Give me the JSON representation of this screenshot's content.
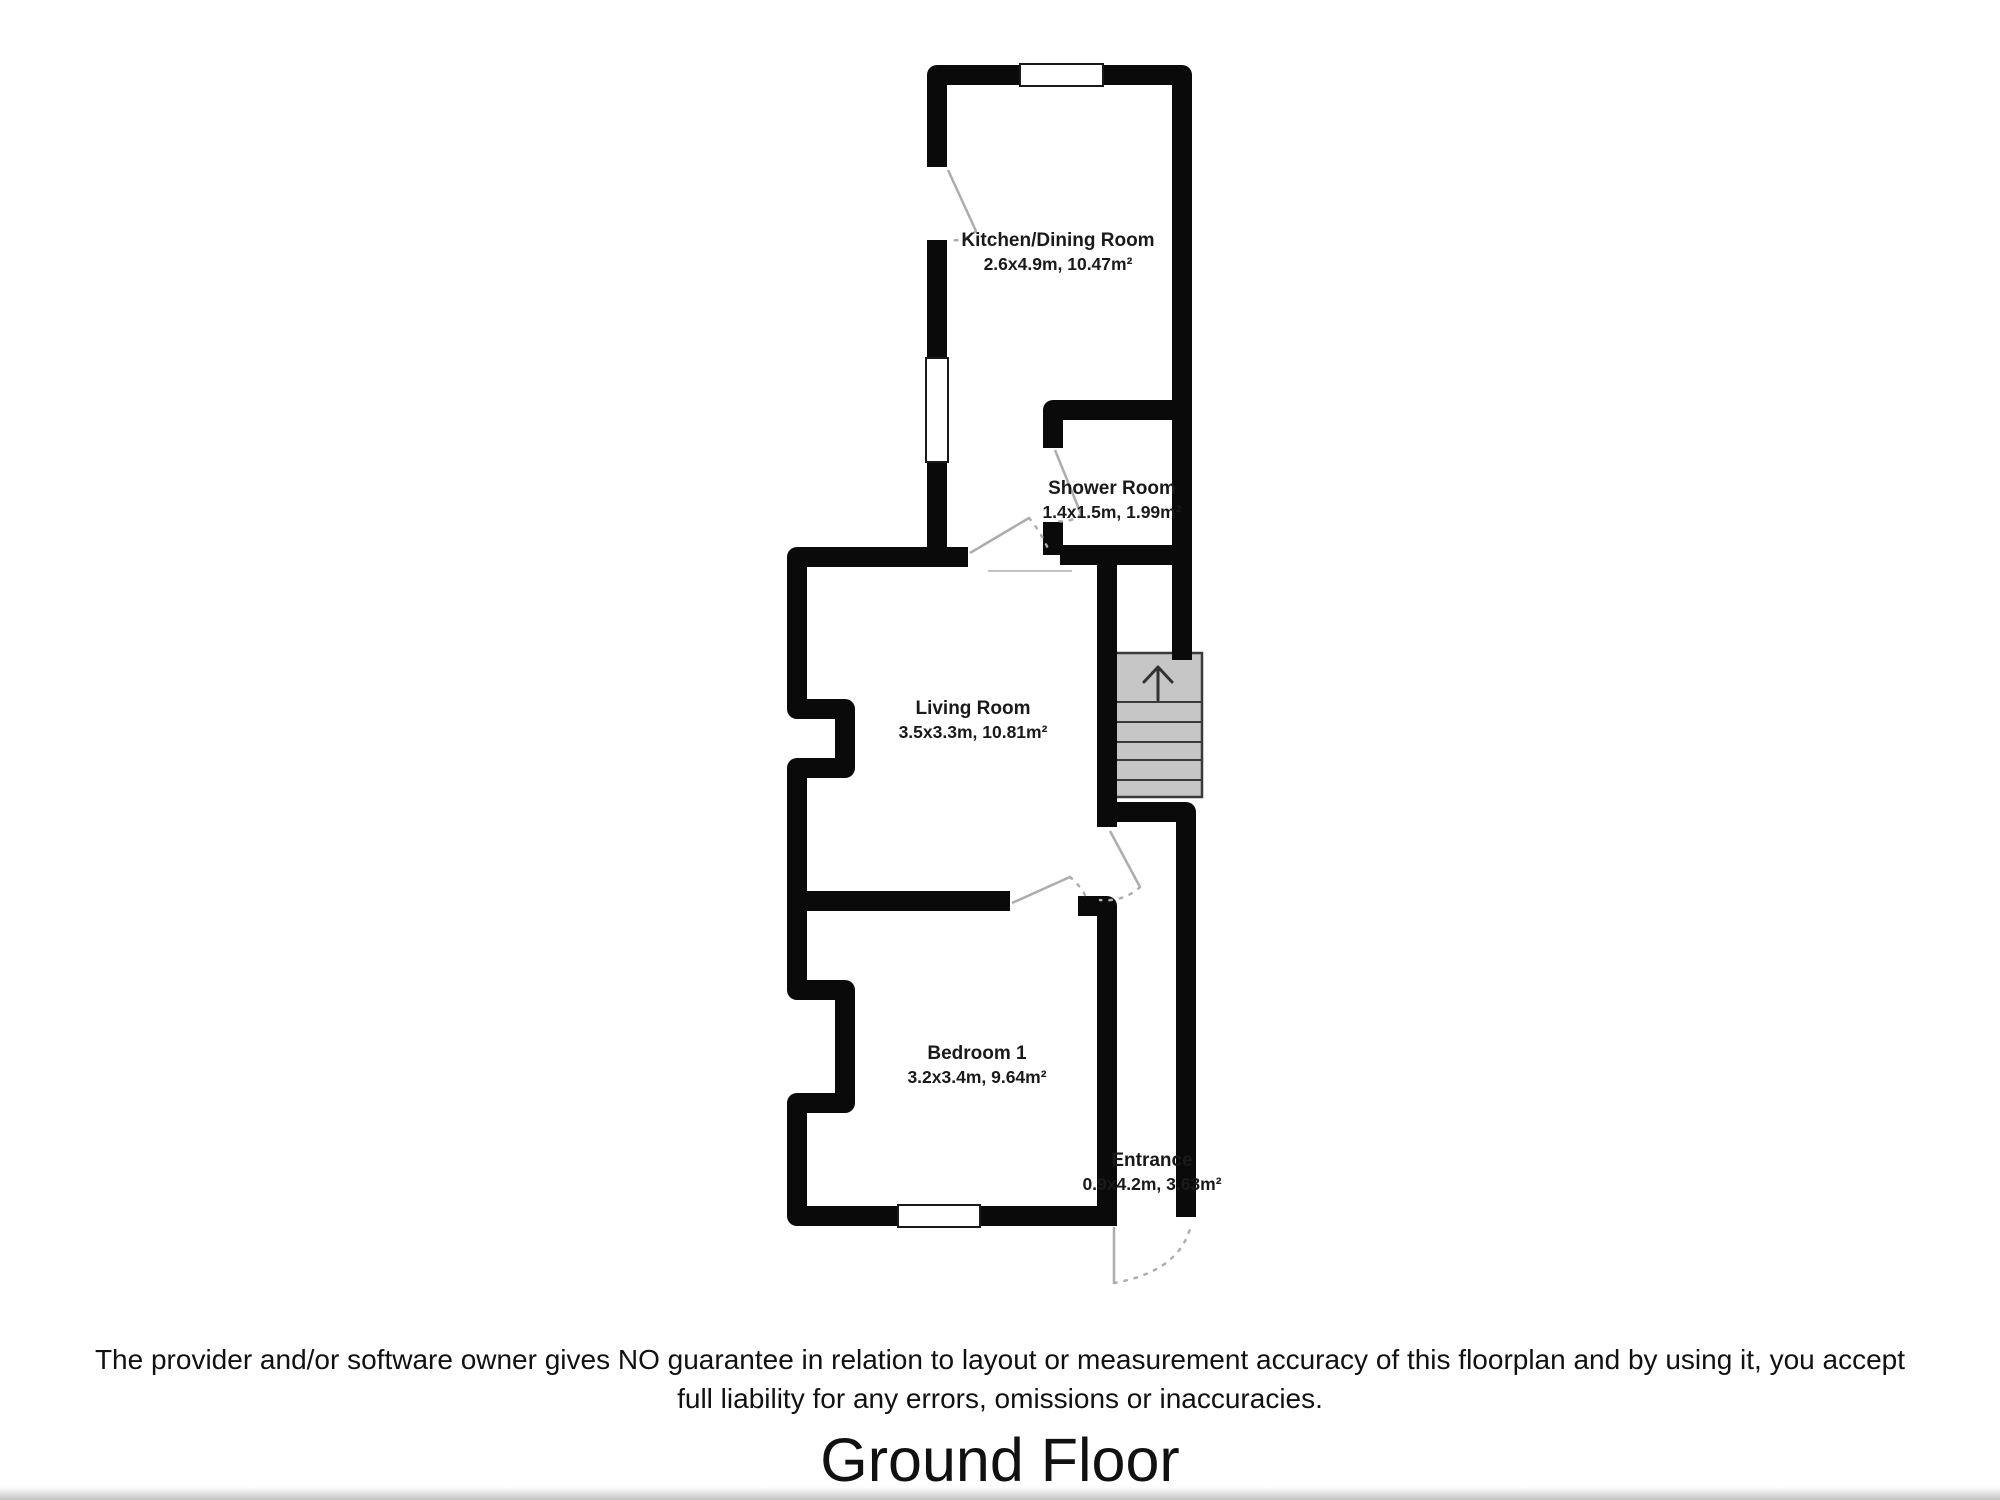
{
  "floorplan": {
    "rooms": [
      {
        "id": "kitchen-dining",
        "name": "Kitchen/Dining Room",
        "dims": "2.6x4.9m, 10.47m²"
      },
      {
        "id": "shower-room",
        "name": "Shower Room",
        "dims": "1.4x1.5m, 1.99m²"
      },
      {
        "id": "living-room",
        "name": "Living Room",
        "dims": "3.5x3.3m, 10.81m²"
      },
      {
        "id": "bedroom-1",
        "name": "Bedroom 1",
        "dims": "3.2x3.4m, 9.64m²"
      },
      {
        "id": "entrance",
        "name": "Entrance",
        "dims": "0.9x4.2m, 3.63m²"
      }
    ],
    "stairs": {
      "icon": "up-arrow",
      "direction": "up"
    },
    "colors": {
      "wall": "#0a0a0a",
      "stair_fill": "#c6c6c6",
      "stair_border": "#3a3a3a",
      "door_line": "#adadad",
      "text": "#1a1a1a"
    }
  },
  "footer": {
    "disclaimer_line1": "The provider and/or software owner gives NO guarantee in relation to layout or measurement accuracy of this floorplan and by using it, you accept",
    "disclaimer_line2": "full liability for any errors, omissions or inaccuracies.",
    "title": "Ground Floor"
  }
}
